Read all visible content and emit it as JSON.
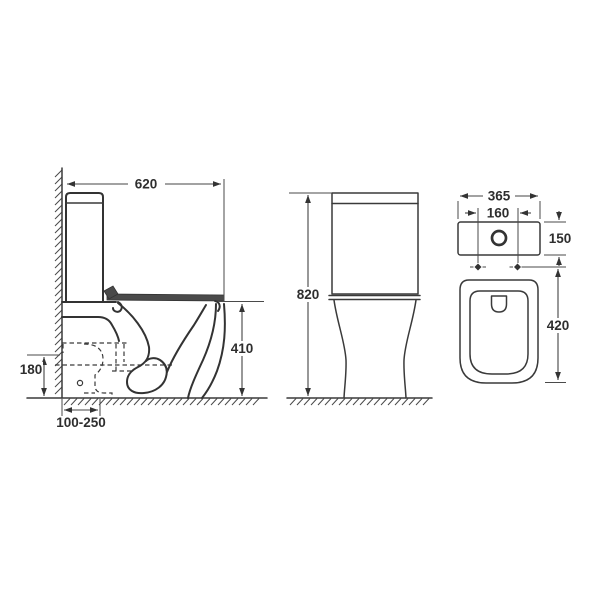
{
  "drawing": {
    "subject": "Close-coupled toilet dimensioned technical drawing, three views",
    "style": "black line drawing on white",
    "line_color": "#333333",
    "views": {
      "side": "side elevation against wall with hidden soil-pipe outline",
      "front": "front elevation",
      "top": "plan view with cistern, flush button, seat fixing holes"
    }
  },
  "dims": {
    "side_total_depth": "620",
    "side_seat_height": "410",
    "side_soil_pipe_height": "180",
    "side_outlet_setout_range": "100-250",
    "front_total_height": "820",
    "top_total_width": "365",
    "top_fixing_hole_spacing": "160",
    "top_cistern_depth": "150",
    "top_pan_length": "420"
  }
}
